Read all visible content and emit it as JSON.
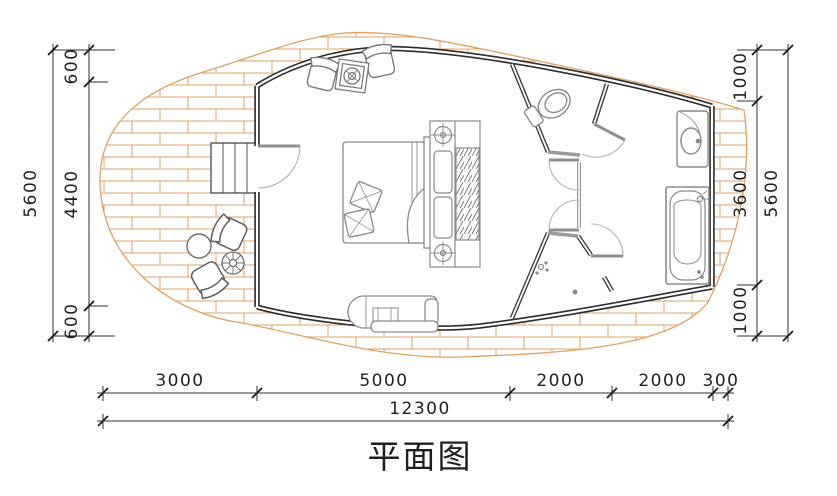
{
  "title": {
    "label": "平面图"
  },
  "dimensions": {
    "left_outer_total": "5600",
    "left_segments": [
      "600",
      "4400",
      "600"
    ],
    "right_segments": [
      "1000",
      "3600",
      "1000"
    ],
    "right_outer_total": "5600",
    "bottom_segments": [
      "3000",
      "5000",
      "2000",
      "2000",
      "300"
    ],
    "bottom_total": "12300"
  },
  "colors": {
    "wall": "#2e2e2e",
    "partition": "#3a3a3a",
    "light_wall": "#9b9b9b",
    "deck_brick": "#e0a264",
    "furniture": "#8a8a8a",
    "dimension": "#1f1f1f",
    "background": "#ffffff"
  },
  "fixtures": [
    "deck-terrace",
    "cabin-shell",
    "entrance-stairs",
    "entrance-door",
    "outdoor-chairs",
    "outdoor-round-table",
    "outdoor-parasol-table",
    "lounge-armchairs",
    "side-table",
    "double-bed",
    "pillows",
    "headboard-console",
    "wardrobe-hanging-rail",
    "console-table",
    "toilet-room",
    "toilet",
    "shower-room",
    "shower-head",
    "vanity-sink",
    "bathtub",
    "interior-doors"
  ]
}
